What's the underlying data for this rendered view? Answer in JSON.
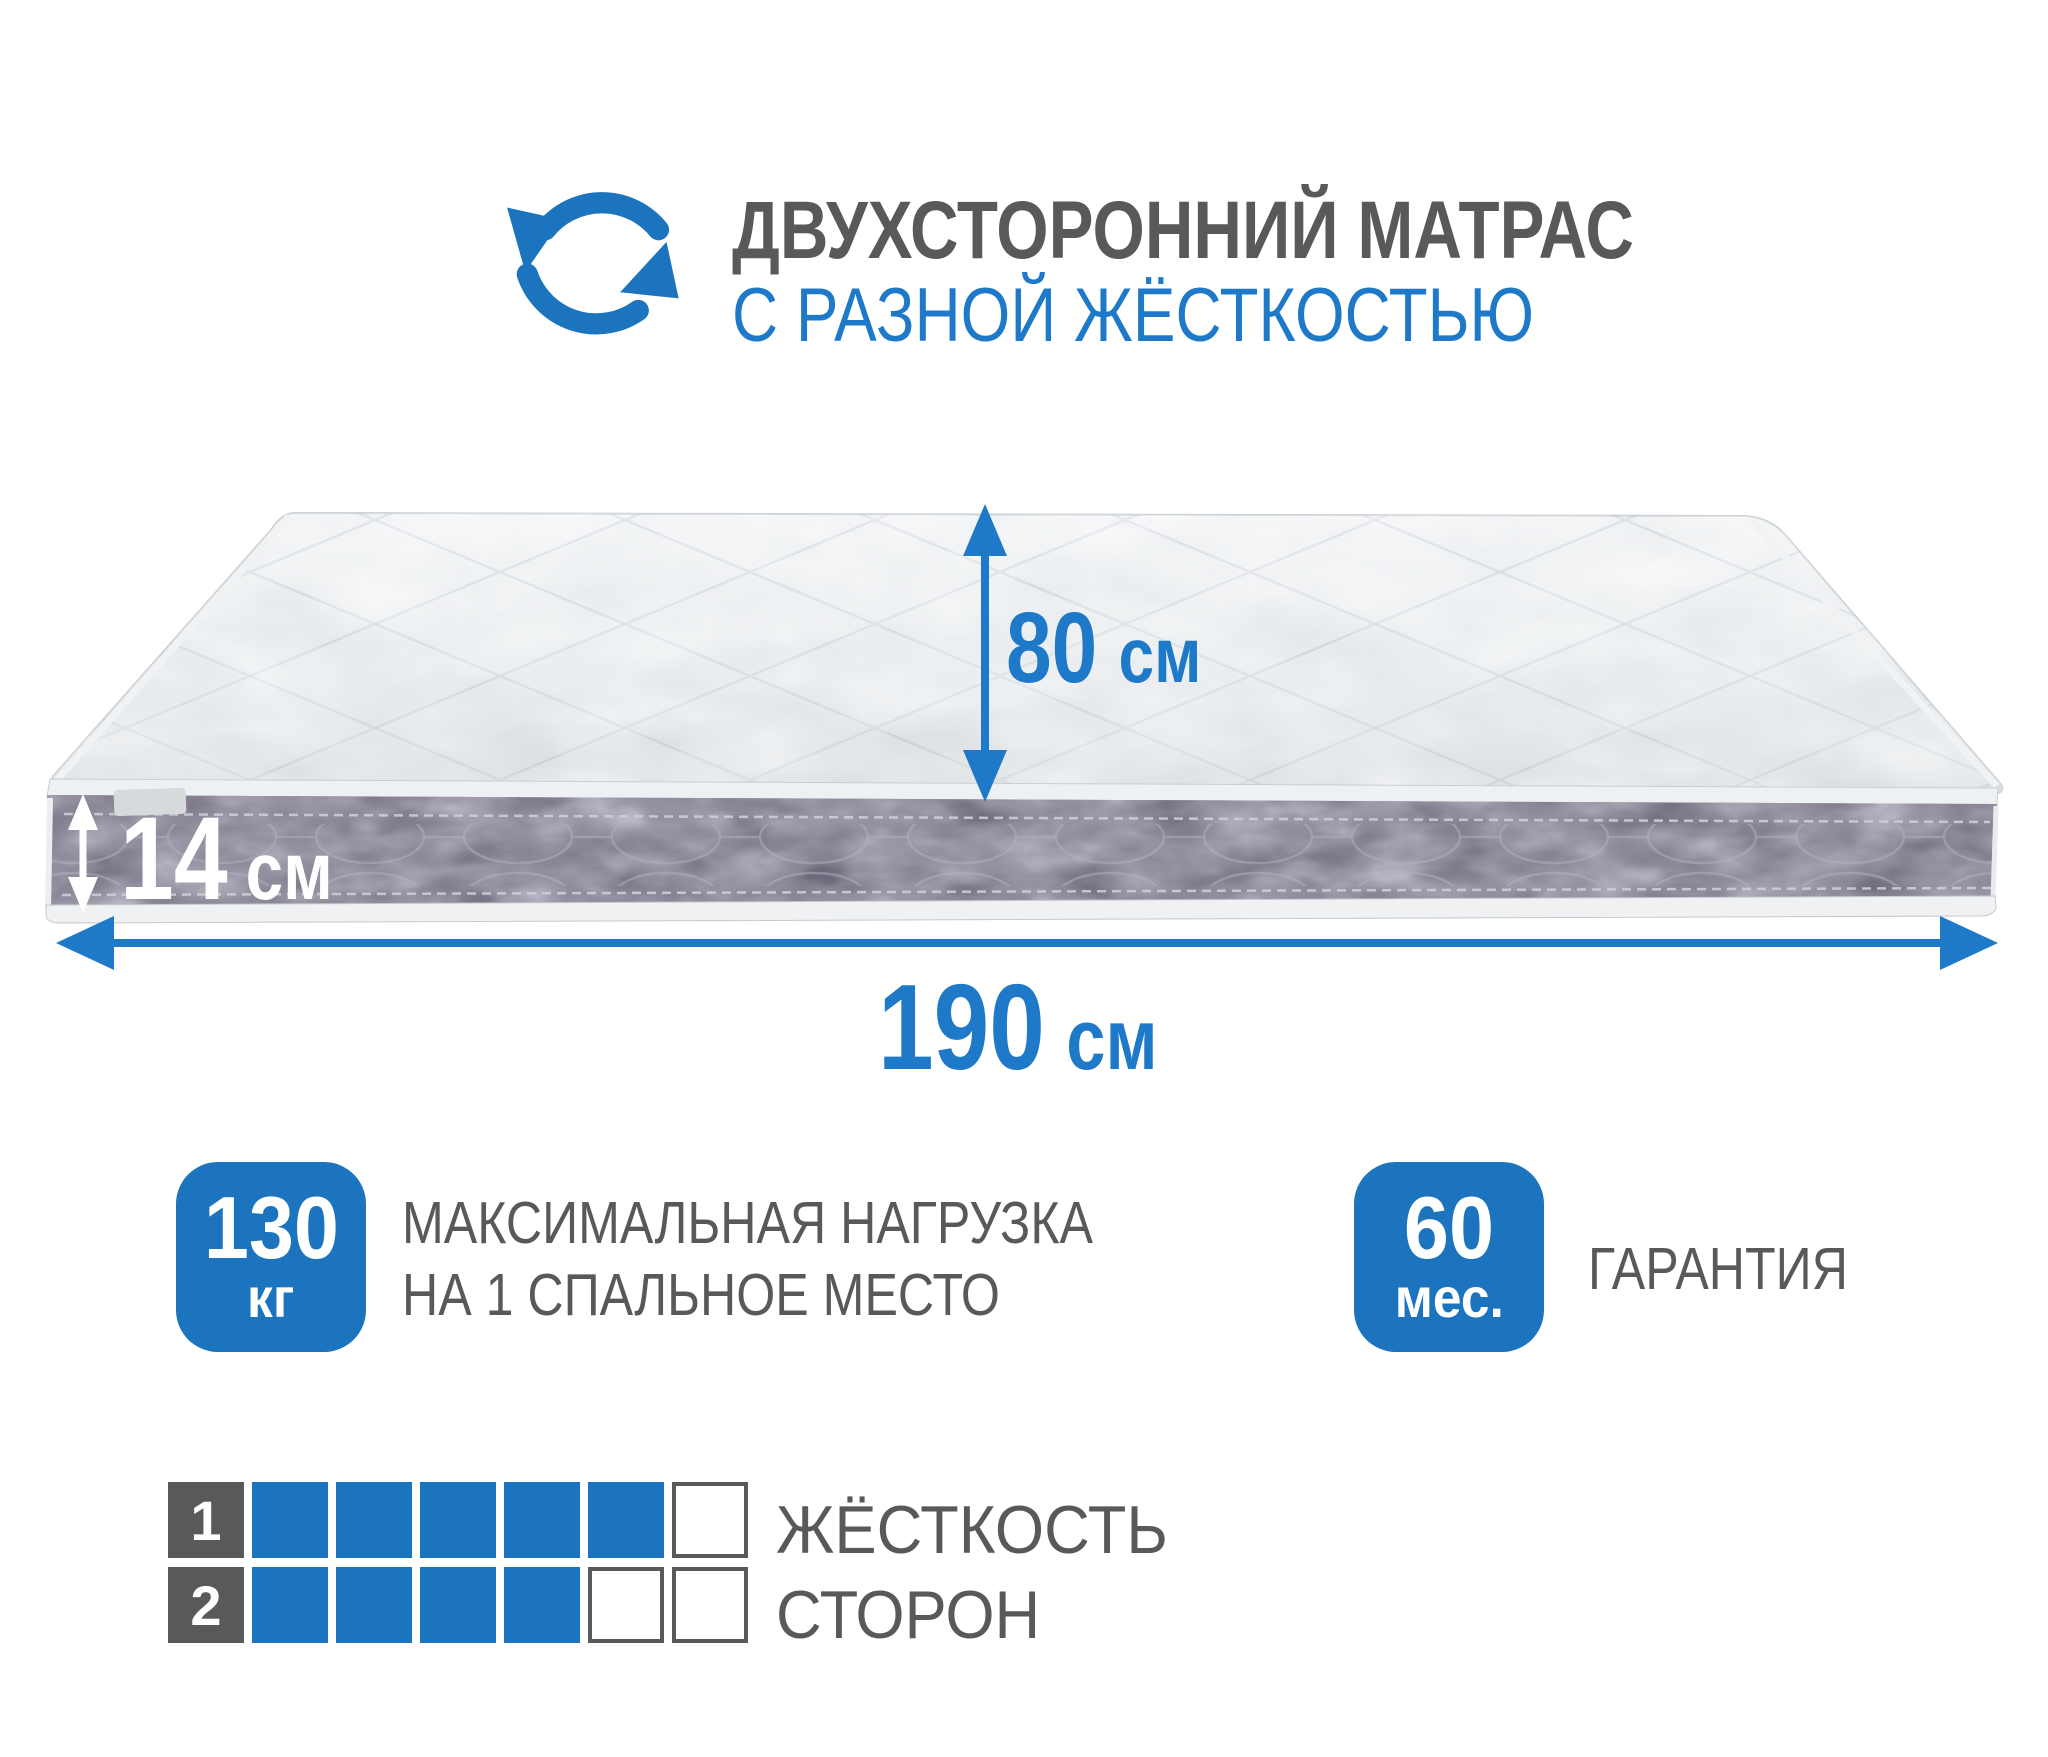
{
  "header": {
    "icon": "rotate-arrows-icon",
    "title_line1": "ДВУХСТОРОННИЙ МАТРАС",
    "title_line2": "С РАЗНОЙ ЖЁСТКОСТЬЮ"
  },
  "dimensions": {
    "width": {
      "value": "80",
      "unit": "см"
    },
    "thickness": {
      "value": "14",
      "unit": "см"
    },
    "length": {
      "value": "190",
      "unit": "см"
    }
  },
  "features": [
    {
      "badge_value": "130",
      "badge_unit": "кг",
      "label_line1": "МАКСИМАЛЬНАЯ НАГРУЗКА",
      "label_line2": "НА 1 СПАЛЬНОЕ МЕСТО"
    },
    {
      "badge_value": "60",
      "badge_unit": "мес.",
      "label_line1": "ГАРАНТИЯ"
    }
  ],
  "hardness": {
    "rows": [
      {
        "label": "1",
        "filled": 5,
        "total": 6
      },
      {
        "label": "2",
        "filled": 4,
        "total": 6
      }
    ],
    "caption_line1": "ЖЁСТКОСТЬ",
    "caption_line2": "СТОРОН"
  },
  "colors": {
    "accent": "#1b74bd",
    "accent_bright": "#1e79c8",
    "text_gray": "#58595b",
    "side_dark": "#6b6778",
    "top_light": "#e6e9ec",
    "white": "#ffffff"
  }
}
